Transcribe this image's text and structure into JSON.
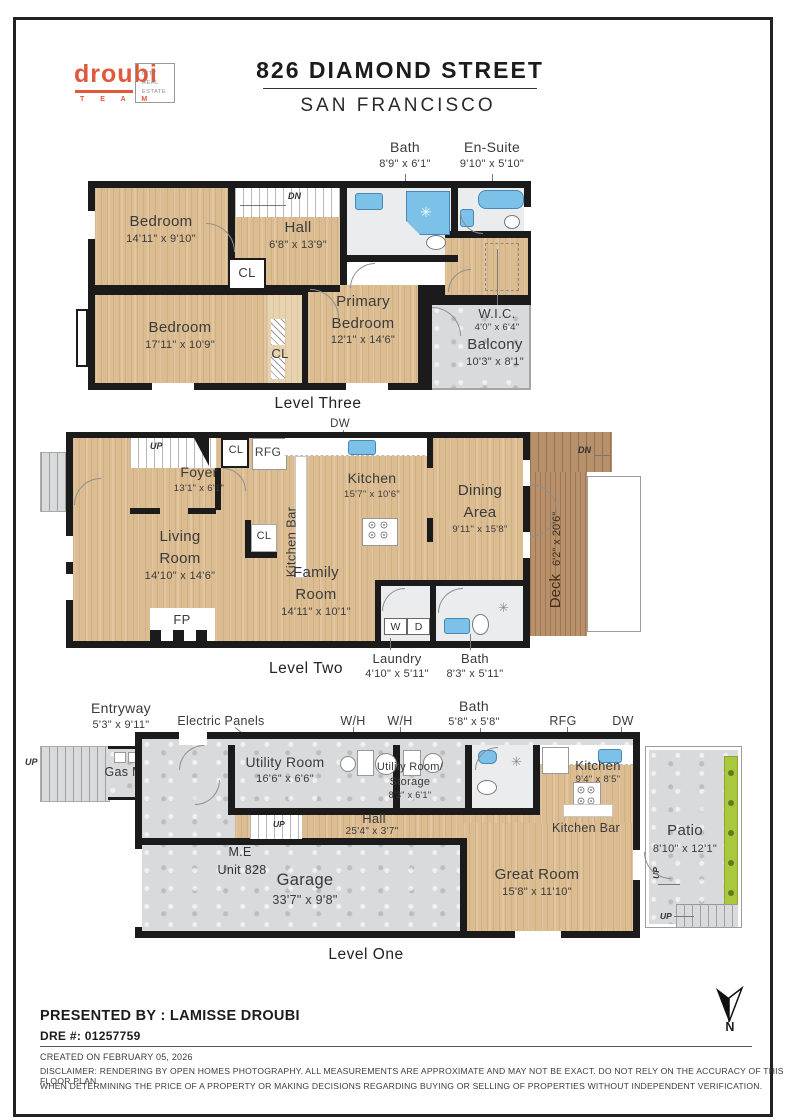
{
  "header": {
    "brand": "droubi",
    "team": "T E A M",
    "badge": "CITY\nREAL\nESTATE",
    "title": "826 DIAMOND STREET",
    "subtitle": "SAN FRANCISCO"
  },
  "icons": {
    "shower_star": "✳"
  },
  "l3": {
    "caption": "Level Three",
    "bath_n": "Bath",
    "bath_d": "8'9\" x 6'1\"",
    "ensuite_n": "En-Suite",
    "ensuite_d": "9'10\" x 5'10\"",
    "dn": "DN",
    "bed1_n": "Bedroom",
    "bed1_d": "14'11\" x 9'10\"",
    "hall_n": "Hall",
    "hall_d": "6'8\" x 13'9\"",
    "cl1": "CL",
    "cl2": "CL",
    "bed2_n": "Bedroom",
    "bed2_d": "17'11\" x 10'9\"",
    "prim_n1": "Primary",
    "prim_n2": "Bedroom",
    "prim_d": "12'1\" x 14'6\"",
    "wic_n": "W.I.C.",
    "wic_d": "4'0\" x 6'4\"",
    "balc_n": "Balcony",
    "balc_d": "10'3\" x 8'1\""
  },
  "l2": {
    "caption": "Level Two",
    "dw": "DW",
    "up": "UP",
    "dn_porch": "DN",
    "porch": "Porch",
    "foyer_n": "Foyer",
    "foyer_d": "13'1\" x 6'1\"",
    "cl1": "CL",
    "rfg": "RFG",
    "kbar": "Kitchen Bar",
    "kitchen_n": "Kitchen",
    "kitchen_d": "15'7\" x 10'6\"",
    "dining_n1": "Dining",
    "dining_n2": "Area",
    "dining_d": "9'11\" x 15'8\"",
    "dn_deck": "DN",
    "deck_n": "Deck",
    "deck_d": "6'2\" x 20'6\"",
    "living_n1": "Living",
    "living_n2": "Room",
    "living_d": "14'10\" x 14'6\"",
    "fp": "FP",
    "cl2": "CL",
    "family_n1": "Family",
    "family_n2": "Room",
    "family_d": "14'11\" x 10'1\"",
    "w": "W",
    "d": "D",
    "laundry_n": "Laundry",
    "laundry_d": "4'10\" x 5'11\"",
    "bath_n": "Bath",
    "bath_d": "8'3\" x 5'11\""
  },
  "l1": {
    "caption": "Level One",
    "entry_n": "Entryway",
    "entry_d": "5'3\" x 9'11\"",
    "panels": "Electric Panels",
    "wh1": "W/H",
    "wh2": "W/H",
    "bath_n": "Bath",
    "bath_d": "5'8\" x 5'8\"",
    "rfg": "RFG",
    "dw": "DW",
    "up_left": "UP",
    "gas": "Gas Meter",
    "util_n": "Utility Room",
    "util_d": "16'6\" x 6'6\"",
    "store_n1": "Utility Room/",
    "store_n2": "Storage",
    "store_d": "8'3\" x 6'1\"",
    "kitchen_n": "Kitchen",
    "kitchen_d": "9'4\" x 8'5\"",
    "kbar": "Kitchen Bar",
    "hall_n": "Hall",
    "hall_d": "25'4\" x 3'7\"",
    "up_hall": "UP",
    "me": "M.E",
    "unit": "Unit 828",
    "garage_n": "Garage",
    "garage_d": "33'7\" x 9'8\"",
    "great_n": "Great Room",
    "great_d": "15'8\" x 11'10\"",
    "patio_n": "Patio",
    "patio_d": "8'10\" x 12'1\"",
    "up_patio1": "UP",
    "up_patio2": "UP"
  },
  "footer": {
    "presented": "PRESENTED BY : LAMISSE DROUBI",
    "dre": "DRE #: 01257759",
    "created": "CREATED ON FEBRUARY 05, 2026",
    "disc1": "DISCLAIMER: RENDERING BY OPEN HOMES PHOTOGRAPHY. ALL MEASUREMENTS ARE APPROXIMATE AND MAY NOT BE EXACT. DO NOT RELY ON THE ACCURACY OF THIS FLOOR PLAN",
    "disc2": "WHEN DETERMINING THE PRICE OF A PROPERTY OR MAKING DECISIONS REGARDING BUYING OR SELLING OF PROPERTIES WITHOUT INDEPENDENT VERIFICATION.",
    "north": "N"
  },
  "colors": {
    "accent": "#E0593C",
    "wall": "#1b1b1b",
    "wood": "#dcbd92",
    "deck": "#b8906a",
    "concrete": "#d8dadb",
    "tile": "#ebeced",
    "fixture_blue": "#7cc2e8",
    "planter_green": "#a9c83d"
  }
}
